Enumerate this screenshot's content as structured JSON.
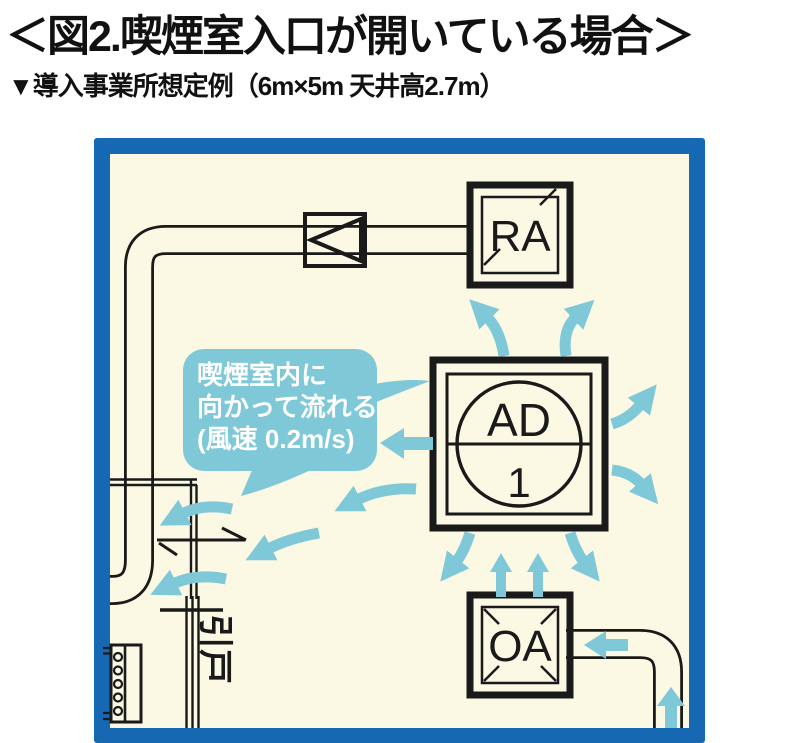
{
  "header": {
    "title": "＜図2.喫煙室入口が開いている場合＞",
    "subtitle": "▼導入事業所想定例（6m×5m 天井高2.7m）"
  },
  "diagram": {
    "callout": {
      "line1": "喫煙室内に",
      "line2": "向かって流れる",
      "line3": "(風速 0.2m/s)"
    },
    "units": {
      "return_air_label": "RA",
      "air_device_label": "AD",
      "air_device_number": "1",
      "outdoor_air_label": "OA"
    },
    "door_label": "引戸",
    "colors": {
      "frame_blue": "#1568B1",
      "room_fill": "#FBF8E4",
      "flow_blue": "#7EC8D8",
      "line_black": "#1A1A1A",
      "callout_text": "#FFFFFF"
    }
  }
}
